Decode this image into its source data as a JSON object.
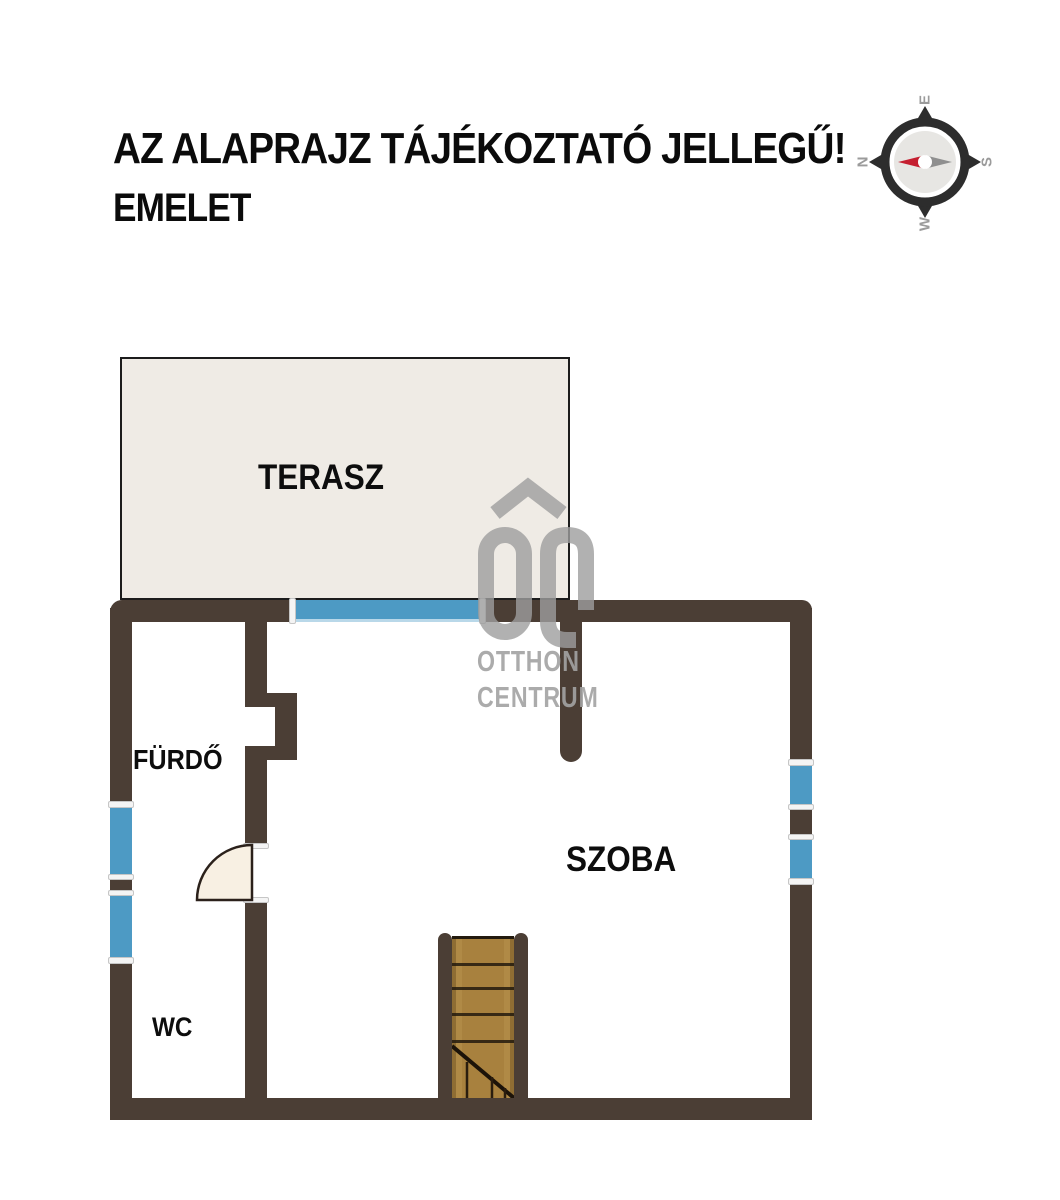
{
  "title": {
    "line1": "AZ ALAPRAJZ TÁJÉKOZTATÓ JELLEGŰ!",
    "line2": "EMELET"
  },
  "compass": {
    "top": "E",
    "left": "N",
    "right": "S",
    "bottom": "W"
  },
  "watermark": {
    "line1": "OTTHON",
    "line2": "CENTRUM"
  },
  "rooms": {
    "terasz": {
      "label": "TERASZ"
    },
    "furdo": {
      "label": "FÜRDŐ"
    },
    "szoba": {
      "label": "SZOBA"
    },
    "wc": {
      "label": "WC"
    }
  },
  "colors": {
    "wall_brown": "#4b3e35",
    "window_blue": "#4d9ac4",
    "terrace_fill": "#efebe5",
    "stairs_wood": "#a8813e",
    "door_leaf": "#f8f0e3",
    "compass_needle_red": "#c51f30",
    "compass_needle_gray": "#8f8f8f",
    "watermark_gray": "#9e9e9e"
  }
}
